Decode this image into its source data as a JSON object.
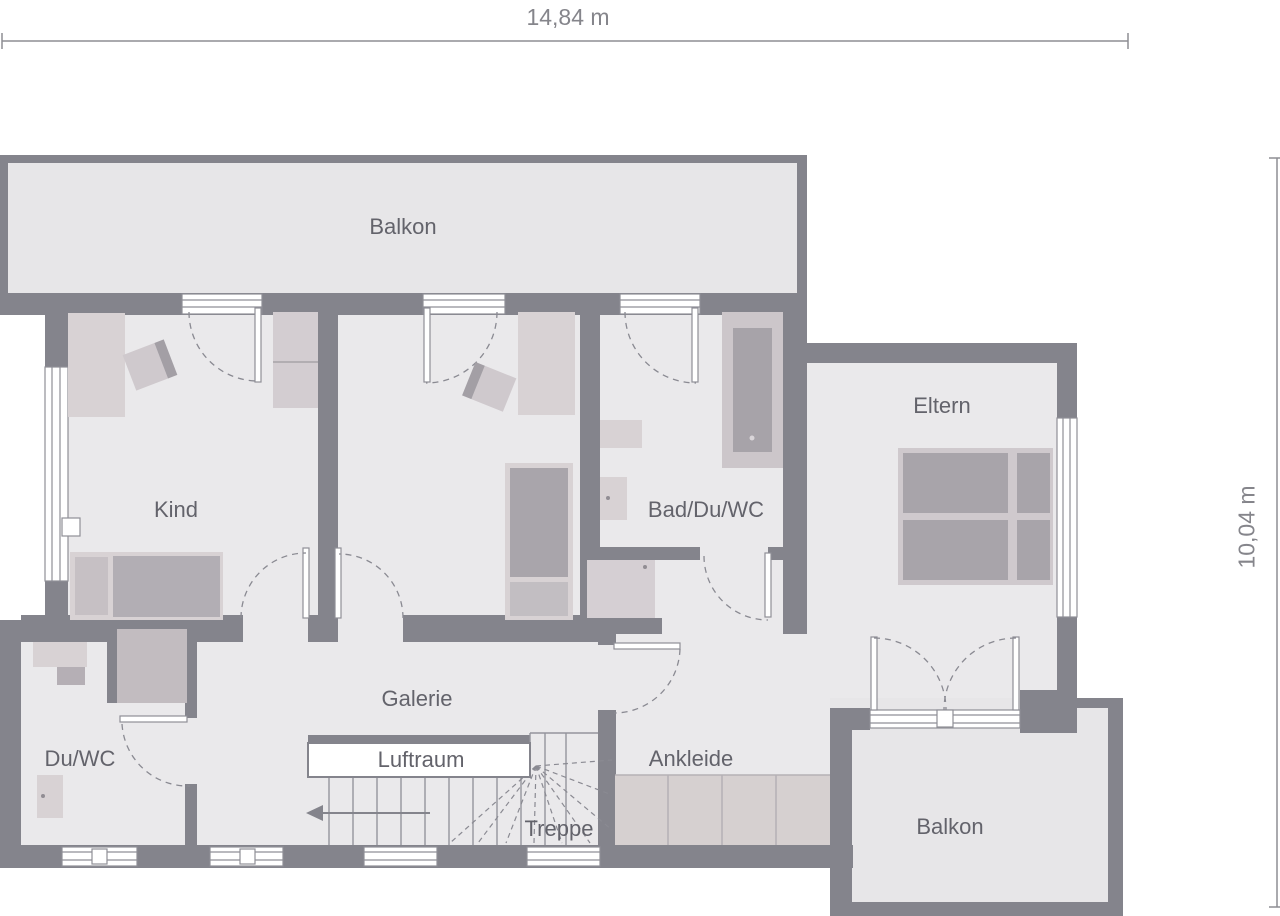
{
  "plan": {
    "title": "floor-plan-upper-storey",
    "rooms": {
      "balkon_top": "Balkon",
      "kind": "Kind",
      "bad": "Bad/Du/WC",
      "eltern": "Eltern",
      "galerie": "Galerie",
      "luftraum": "Luftraum",
      "treppe": "Treppe",
      "ankleide": "Ankleide",
      "du_wc": "Du/WC",
      "balkon_bottom": "Balkon"
    },
    "dimensions": {
      "width_label": "14,84 m",
      "height_label": "10,04 m"
    },
    "colors": {
      "wall": "#84848c",
      "floor": "#eae9eb",
      "balcony_floor": "#e7e6e8",
      "furniture_light": "#d8d2d4",
      "furniture_mid": "#c7c1c5",
      "furniture_dark": "#a8a4aa",
      "frame_line": "#8f8f97",
      "dash_line": "#8a8a92",
      "label_text": "#63636b",
      "dimension_text": "#85858b"
    }
  }
}
